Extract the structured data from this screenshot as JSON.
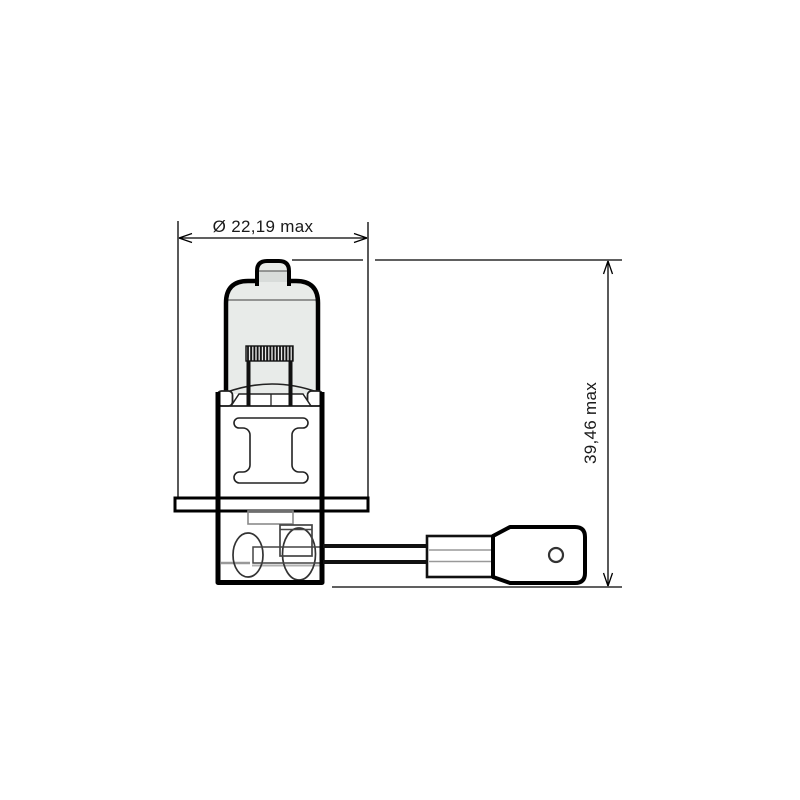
{
  "page": {
    "background": "#ffffff"
  },
  "diagram": {
    "labels": {
      "diameter": "Ø 22,19 max",
      "height": "39,46 max"
    },
    "colors": {
      "line": "#000000",
      "glass_fill": "#e8ebe9",
      "glass_shade": "#d8dcda",
      "detail_gray": "#999999"
    }
  }
}
